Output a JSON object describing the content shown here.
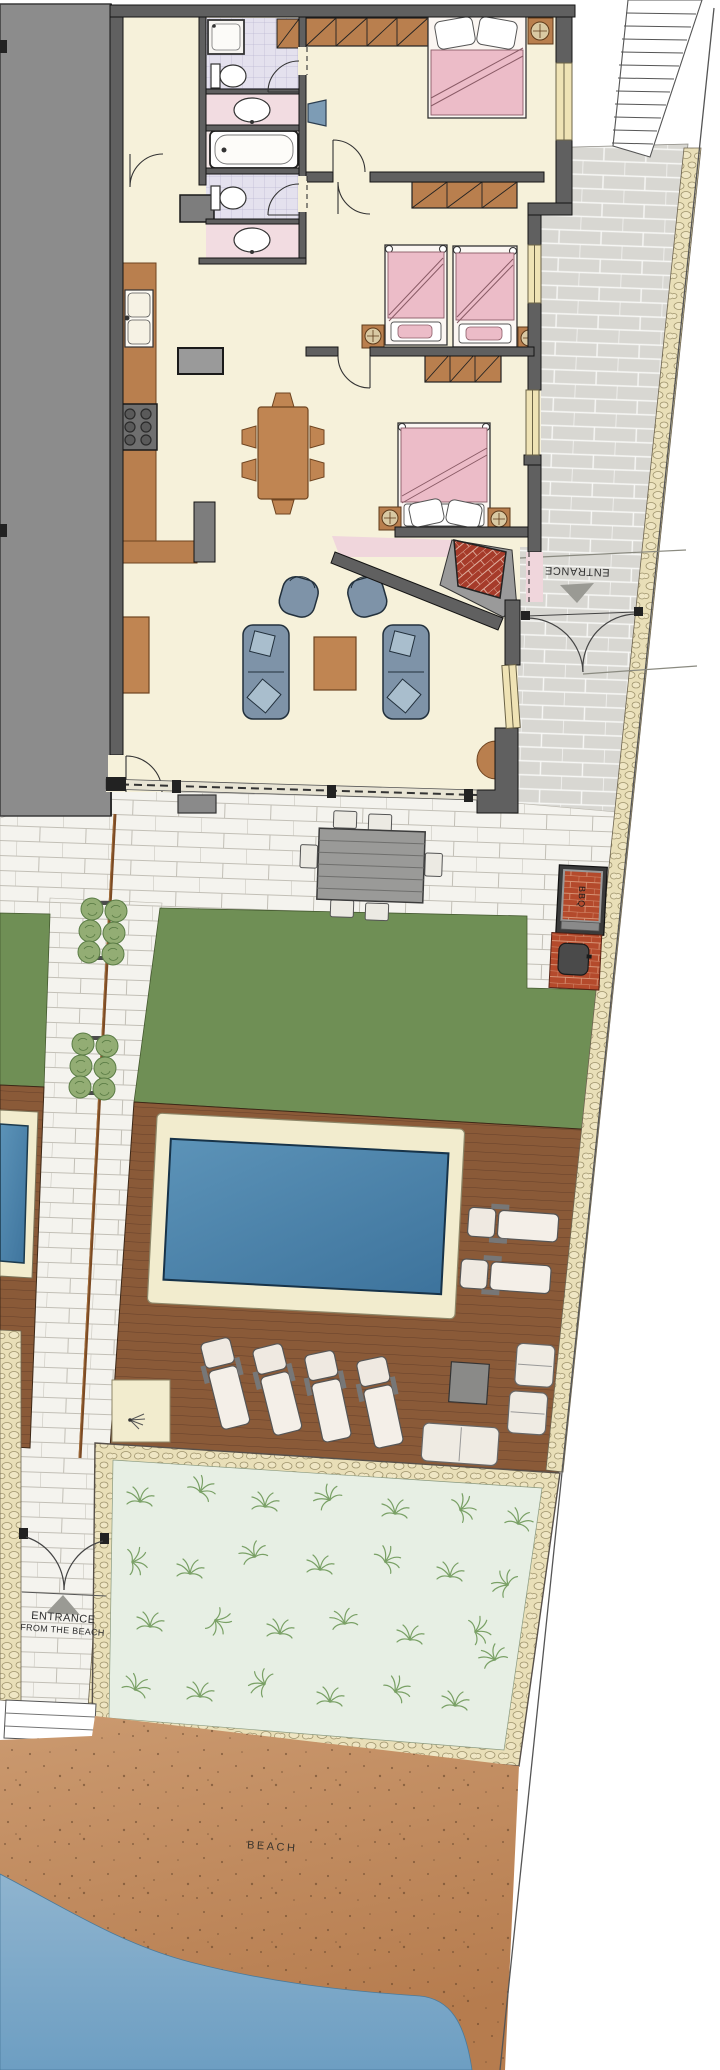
{
  "labels": {
    "entrance": "ENTRANCE",
    "beach_entrance_line1": "ENTRANCE",
    "beach_entrance_line2": "FROM THE BEACH",
    "bbq": "BBQ",
    "beach": "BEACH"
  },
  "colors": {
    "neighbor_building": "#8c8c8c",
    "wall": "#606060",
    "floor_cream": "#f6f1da",
    "bathroom_tile": "#e4e1ee",
    "vanity_pink": "#f2dce1",
    "hall_pink": "#f0d6dc",
    "wood_furniture": "#c08552",
    "wardrobe": "#b97f4e",
    "bed_pink": "#ecbcc8",
    "sofa_blue": "#7e93a8",
    "gray_paving": "#d8d7d2",
    "white_paving": "#f4f3ee",
    "stone_border": "#e9dfb8",
    "lawn": "#6f8f55",
    "deck": "#8a5a38",
    "pool_water": "#4a84ad",
    "pool_coping": "#f2ecce",
    "garden_bg": "#e7efe4",
    "plant_green": "#79a065",
    "sand": "#c08552",
    "sea": "#7ca8c9",
    "brick_red": "#b44a2c",
    "arrow_gray": "#9a9a94"
  }
}
